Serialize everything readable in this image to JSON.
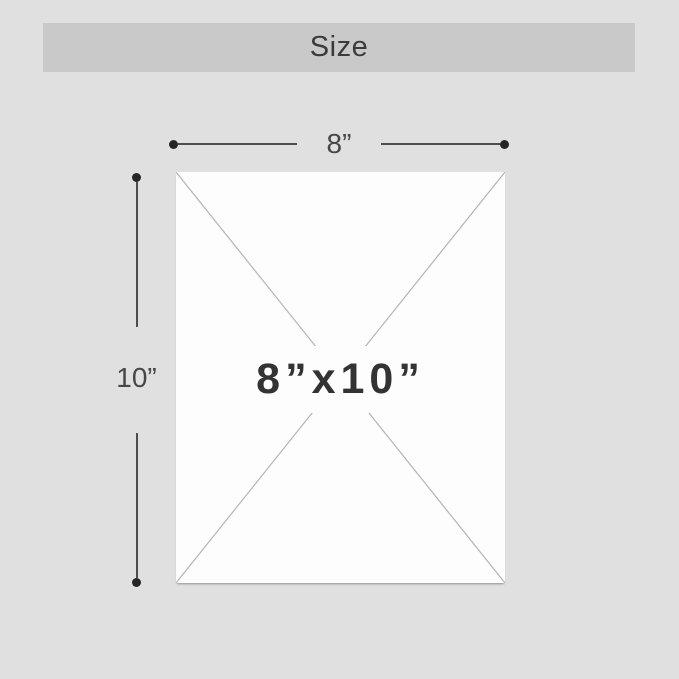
{
  "header": {
    "title": "Size"
  },
  "diagram": {
    "width_label": "8”",
    "height_label": "10”",
    "size_label": "8”x10”"
  },
  "colors": {
    "page_background": "#e0e0e0",
    "header_background": "#c9c9c9",
    "header_text": "#3b3b3b",
    "panel_background": "#fdfdfd",
    "diagonal_line": "#b4b4b4",
    "dimension_line": "#4d4d4d",
    "dimension_dot": "#262626",
    "size_text": "#333333"
  }
}
